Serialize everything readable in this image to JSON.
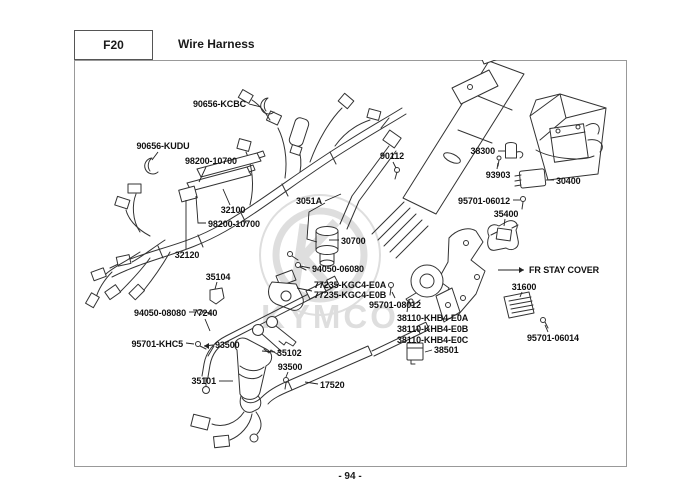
{
  "header": {
    "code": "F20",
    "title": "Wire Harness"
  },
  "footer": {
    "page_number": "- 94 -"
  },
  "watermark": {
    "brand": "KYMCO"
  },
  "diagram": {
    "labels": [
      {
        "text": "90656-KCBC",
        "x": 246,
        "y": 107,
        "anchor": "end",
        "leaders": [
          [
            [
              249,
              104
            ],
            [
              261,
              107
            ]
          ]
        ]
      },
      {
        "text": "90656-KUDU",
        "x": 163,
        "y": 149,
        "anchor": "middle",
        "leaders": [
          [
            [
              158,
              152
            ],
            [
              152,
              160
            ]
          ]
        ]
      },
      {
        "text": "98200-10700",
        "x": 211,
        "y": 164,
        "anchor": "middle",
        "leaders": [
          [
            [
              206,
              167
            ],
            [
              199,
              182
            ]
          ]
        ]
      },
      {
        "text": "32100",
        "x": 233,
        "y": 213,
        "anchor": "middle",
        "leaders": [
          [
            [
              230,
              205
            ],
            [
              223,
              189
            ]
          ]
        ]
      },
      {
        "text": "98200-10700",
        "x": 208,
        "y": 227,
        "anchor": "start",
        "leaders": [
          [
            [
              206,
              223
            ],
            [
              198,
              223
            ],
            [
              196,
              196
            ]
          ]
        ]
      },
      {
        "text": "32120",
        "x": 187,
        "y": 258,
        "anchor": "middle",
        "leaders": [
          [
            [
              186,
              249
            ],
            [
              186,
              200
            ]
          ]
        ]
      },
      {
        "text": "35104",
        "x": 218,
        "y": 280,
        "anchor": "middle",
        "leaders": [
          [
            [
              217,
              282
            ],
            [
              215,
              289
            ]
          ]
        ]
      },
      {
        "text": "94050-08080",
        "x": 186,
        "y": 316,
        "anchor": "end",
        "leaders": [
          [
            [
              189,
              312
            ],
            [
              196,
              312
            ]
          ]
        ]
      },
      {
        "text": "77240",
        "x": 205,
        "y": 316,
        "anchor": "middle",
        "leaders": [
          [
            [
              205,
              319
            ],
            [
              210,
              331
            ]
          ]
        ]
      },
      {
        "text": "95701-KHC5",
        "x": 183,
        "y": 347,
        "anchor": "end",
        "leaders": [
          [
            [
              186,
              343
            ],
            [
              194,
              344
            ]
          ]
        ]
      },
      {
        "text": "93500",
        "x": 215,
        "y": 348,
        "anchor": "start",
        "arrow": "left",
        "leaders": [
          [
            [
              213,
              345
            ],
            [
              204,
              346
            ]
          ]
        ]
      },
      {
        "text": "35102",
        "x": 277,
        "y": 356,
        "anchor": "start",
        "leaders": [
          [
            [
              275,
              352
            ],
            [
              262,
              351
            ]
          ]
        ]
      },
      {
        "text": "93500",
        "x": 290,
        "y": 370,
        "anchor": "middle",
        "leaders": [
          [
            [
              288,
              372
            ],
            [
              286,
              377
            ]
          ]
        ]
      },
      {
        "text": "35101",
        "x": 216,
        "y": 384,
        "anchor": "end",
        "leaders": [
          [
            [
              219,
              381
            ],
            [
              233,
              381
            ]
          ]
        ]
      },
      {
        "text": "17520",
        "x": 320,
        "y": 388,
        "anchor": "start",
        "leaders": [
          [
            [
              318,
              384
            ],
            [
              305,
              382
            ]
          ]
        ]
      },
      {
        "text": "90112",
        "x": 392,
        "y": 159,
        "anchor": "middle",
        "leaders": [
          [
            [
              393,
              162
            ],
            [
              396,
              168
            ]
          ]
        ]
      },
      {
        "text": "3051A",
        "x": 322,
        "y": 204,
        "anchor": "end",
        "leaders": [
          [
            [
              325,
              201
            ],
            [
              341,
              194
            ]
          ],
          [
            [
              325,
              203
            ],
            [
              309,
              212
            ],
            [
              307,
              239
            ],
            [
              317,
              242
            ]
          ]
        ]
      },
      {
        "text": "30700",
        "x": 341,
        "y": 244,
        "anchor": "start",
        "leaders": [
          [
            [
              339,
              240
            ],
            [
              329,
              240
            ]
          ]
        ]
      },
      {
        "text": "94050-06080",
        "x": 312,
        "y": 272,
        "anchor": "start",
        "leaders": [
          [
            [
              310,
              268
            ],
            [
              300,
              266
            ]
          ]
        ]
      },
      {
        "text": "77235-KGC4-E0A",
        "x": 314,
        "y": 288,
        "anchor": "start",
        "leaders": [
          [
            [
              312,
              291
            ],
            [
              297,
              288
            ]
          ]
        ]
      },
      {
        "text": "77235-KGC4-E0B",
        "x": 314,
        "y": 298,
        "anchor": "start",
        "leaders": []
      },
      {
        "text": "95701-08012",
        "x": 395,
        "y": 308,
        "anchor": "middle",
        "leaders": [
          [
            [
              395,
              298
            ],
            [
              392,
              292
            ]
          ]
        ]
      },
      {
        "text": "38110-KHB4-E0A",
        "x": 397,
        "y": 321,
        "anchor": "start",
        "leaders": [
          [
            [
              407,
              312
            ],
            [
              409,
              299
            ]
          ]
        ]
      },
      {
        "text": "38110-KHB4-E0B",
        "x": 397,
        "y": 332,
        "anchor": "start",
        "leaders": []
      },
      {
        "text": "38110-KHB4-E0C",
        "x": 397,
        "y": 343,
        "anchor": "start",
        "leaders": []
      },
      {
        "text": "38501",
        "x": 434,
        "y": 353,
        "anchor": "start",
        "leaders": [
          [
            [
              432,
              350
            ],
            [
              425,
              352
            ]
          ]
        ]
      },
      {
        "text": "38300",
        "x": 495,
        "y": 154,
        "anchor": "end",
        "leaders": [
          [
            [
              498,
              151
            ],
            [
              505,
              151
            ]
          ]
        ]
      },
      {
        "text": "93903",
        "x": 498,
        "y": 178,
        "anchor": "middle",
        "leaders": [
          [
            [
              497,
              169
            ],
            [
              498,
              163
            ]
          ]
        ]
      },
      {
        "text": "30400",
        "x": 556,
        "y": 184,
        "anchor": "start",
        "leaders": [
          [
            [
              554,
              180
            ],
            [
              546,
              180
            ]
          ]
        ]
      },
      {
        "text": "95701-06012",
        "x": 510,
        "y": 204,
        "anchor": "end",
        "leaders": [
          [
            [
              513,
              200
            ],
            [
              520,
              200
            ]
          ]
        ]
      },
      {
        "text": "35400",
        "x": 506,
        "y": 217,
        "anchor": "middle",
        "leaders": [
          [
            [
              505,
              219
            ],
            [
              504,
              226
            ]
          ]
        ]
      },
      {
        "text": "FR STAY COVER",
        "x": 529,
        "y": 273,
        "anchor": "start",
        "arrow": "right",
        "leaders": [
          [
            [
              498,
              270
            ],
            [
              524,
              270
            ]
          ]
        ]
      },
      {
        "text": "31600",
        "x": 524,
        "y": 290,
        "anchor": "middle",
        "leaders": [
          [
            [
              522,
              292
            ],
            [
              520,
              297
            ]
          ]
        ]
      },
      {
        "text": "95701-06014",
        "x": 553,
        "y": 341,
        "anchor": "middle",
        "leaders": [
          [
            [
              548,
              332
            ],
            [
              545,
              325
            ]
          ]
        ]
      }
    ]
  }
}
